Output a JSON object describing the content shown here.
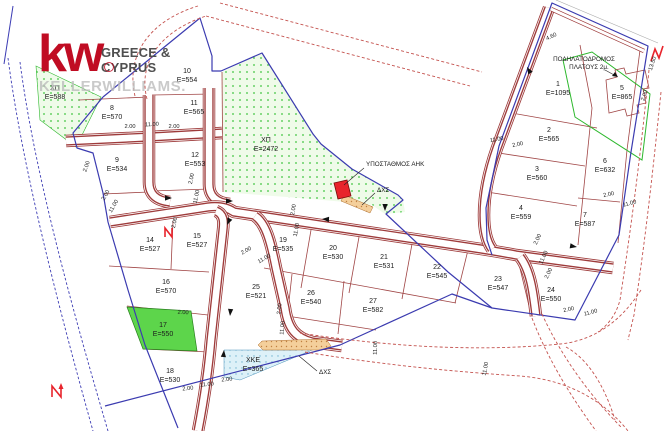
{
  "logo": {
    "mark": "kw",
    "region_line1": "GREECE &",
    "region_line2": "CYPRUS",
    "brand": "KELLERWILLIAMS."
  },
  "colors": {
    "logo_red": "#c00c23",
    "brand_gray": "#bdbdbd",
    "boundary_blue": "#3b3bb0",
    "road_red": "#9e3b3b",
    "dashed_road_red": "#c4524e",
    "water_blue": "#3c3cb4",
    "plot_line": "#a04545",
    "green_dot": "#3fc43f",
    "green_bg": "#effbe9",
    "plot17_green": "#5dd54b",
    "xke_blue": "#ddf1f8",
    "strip_tan": "#f4cf9b",
    "substation_red": "#e8242c",
    "text_dark": "#1c1c1c"
  },
  "map": {
    "plots": [
      {
        "n": "1",
        "a": "E=1095",
        "x": 558,
        "y": 86
      },
      {
        "n": "2",
        "a": "E=565",
        "x": 549,
        "y": 132
      },
      {
        "n": "3",
        "a": "E=560",
        "x": 537,
        "y": 171
      },
      {
        "n": "4",
        "a": "E=559",
        "x": 521,
        "y": 210
      },
      {
        "n": "5",
        "a": "E=865",
        "x": 622,
        "y": 90
      },
      {
        "n": "6",
        "a": "E=632",
        "x": 605,
        "y": 163
      },
      {
        "n": "7",
        "a": "E=587",
        "x": 585,
        "y": 217
      },
      {
        "n": "8",
        "a": "E=570",
        "x": 112,
        "y": 110
      },
      {
        "n": "9",
        "a": "E=534",
        "x": 117,
        "y": 162
      },
      {
        "n": "10",
        "a": "E=554",
        "x": 187,
        "y": 73
      },
      {
        "n": "11",
        "a": "E=565",
        "x": 194,
        "y": 105
      },
      {
        "n": "12",
        "a": "E=553",
        "x": 195,
        "y": 157
      },
      {
        "n": "14",
        "a": "E=527",
        "x": 150,
        "y": 242
      },
      {
        "n": "15",
        "a": "E=527",
        "x": 197,
        "y": 238
      },
      {
        "n": "16",
        "a": "E=570",
        "x": 166,
        "y": 284
      },
      {
        "n": "17",
        "a": "E=550",
        "x": 163,
        "y": 327
      },
      {
        "n": "18",
        "a": "E=530",
        "x": 170,
        "y": 373
      },
      {
        "n": "19",
        "a": "E=535",
        "x": 283,
        "y": 242
      },
      {
        "n": "20",
        "a": "E=530",
        "x": 333,
        "y": 250
      },
      {
        "n": "21",
        "a": "E=531",
        "x": 384,
        "y": 259
      },
      {
        "n": "22",
        "a": "E=545",
        "x": 437,
        "y": 269
      },
      {
        "n": "23",
        "a": "E=547",
        "x": 498,
        "y": 281
      },
      {
        "n": "24",
        "a": "E=550",
        "x": 551,
        "y": 292
      },
      {
        "n": "25",
        "a": "E=521",
        "x": 256,
        "y": 289
      },
      {
        "n": "26",
        "a": "E=540",
        "x": 311,
        "y": 295
      },
      {
        "n": "27",
        "a": "E=582",
        "x": 373,
        "y": 303
      },
      {
        "n": "ΧΠ",
        "a": "E=588",
        "x": 55,
        "y": 90
      },
      {
        "n": "ΧΠ",
        "a": "E=2472",
        "x": 266,
        "y": 142
      },
      {
        "n": "ΧΚΕ",
        "a": "E=365",
        "x": 253,
        "y": 362
      }
    ],
    "dimensions": [
      {
        "t": "2.00",
        "x": 130,
        "y": 128,
        "r": 0
      },
      {
        "t": "11.00",
        "x": 152,
        "y": 126,
        "r": -3
      },
      {
        "t": "2.00",
        "x": 174,
        "y": 128,
        "r": 0
      },
      {
        "t": "2.00",
        "x": 88,
        "y": 167,
        "r": -70
      },
      {
        "t": "2.00",
        "x": 107,
        "y": 196,
        "r": -60
      },
      {
        "t": "11.00",
        "x": 115,
        "y": 207,
        "r": -60
      },
      {
        "t": "2.00",
        "x": 193,
        "y": 179,
        "r": -78
      },
      {
        "t": "11.00",
        "x": 198,
        "y": 197,
        "r": -78
      },
      {
        "t": "2.00",
        "x": 176,
        "y": 223,
        "r": -78
      },
      {
        "t": "2.00",
        "x": 247,
        "y": 252,
        "r": -30
      },
      {
        "t": "11.00",
        "x": 265,
        "y": 260,
        "r": -30
      },
      {
        "t": "2.00",
        "x": 295,
        "y": 210,
        "r": -80
      },
      {
        "t": "11.00",
        "x": 298,
        "y": 230,
        "r": -80
      },
      {
        "t": "2.00",
        "x": 281,
        "y": 309,
        "r": -85
      },
      {
        "t": "11.00",
        "x": 284,
        "y": 328,
        "r": -85
      },
      {
        "t": "2.00",
        "x": 188,
        "y": 390,
        "r": -5
      },
      {
        "t": "11.00",
        "x": 207,
        "y": 386,
        "r": -5
      },
      {
        "t": "2.00",
        "x": 227,
        "y": 381,
        "r": -5
      },
      {
        "t": "2.00",
        "x": 183,
        "y": 314,
        "r": 3
      },
      {
        "t": "11.00",
        "x": 497,
        "y": 141,
        "r": -10
      },
      {
        "t": "2.00",
        "x": 518,
        "y": 146,
        "r": -12
      },
      {
        "t": "2.00",
        "x": 609,
        "y": 196,
        "r": -12
      },
      {
        "t": "11.00",
        "x": 630,
        "y": 205,
        "r": -15
      },
      {
        "t": "4.60",
        "x": 552,
        "y": 38,
        "r": -25
      },
      {
        "t": "13.50",
        "x": 654,
        "y": 64,
        "r": -72
      },
      {
        "t": "2.00",
        "x": 646,
        "y": 96,
        "r": -72
      },
      {
        "t": "2.00",
        "x": 539,
        "y": 240,
        "r": -65
      },
      {
        "t": "11.00",
        "x": 545,
        "y": 258,
        "r": -65
      },
      {
        "t": "2.00",
        "x": 550,
        "y": 274,
        "r": -65
      },
      {
        "t": "2.00",
        "x": 569,
        "y": 311,
        "r": -12
      },
      {
        "t": "11.00",
        "x": 591,
        "y": 314,
        "r": -15
      },
      {
        "t": "11.00",
        "x": 377,
        "y": 348,
        "r": -88
      },
      {
        "t": "11.00",
        "x": 487,
        "y": 369,
        "r": -80
      }
    ],
    "annotations": [
      {
        "t": "ΥΠΟΣΤΑΘΜΟΣ ΑΗΚ",
        "x": 366,
        "y": 166,
        "anchor": "start"
      },
      {
        "t": "ΔΧΣ",
        "x": 377,
        "y": 192,
        "anchor": "start"
      },
      {
        "t": "ΔΧΣ",
        "x": 319,
        "y": 374,
        "anchor": "start"
      },
      {
        "t": "ΠΟΔΗΛΑΤΟΔΡΟΜΟΣ",
        "x": 584,
        "y": 61,
        "anchor": "middle"
      },
      {
        "t": "ΠΛΑΤΟΥΣ 2μ.",
        "x": 589,
        "y": 69,
        "anchor": "middle"
      }
    ]
  }
}
